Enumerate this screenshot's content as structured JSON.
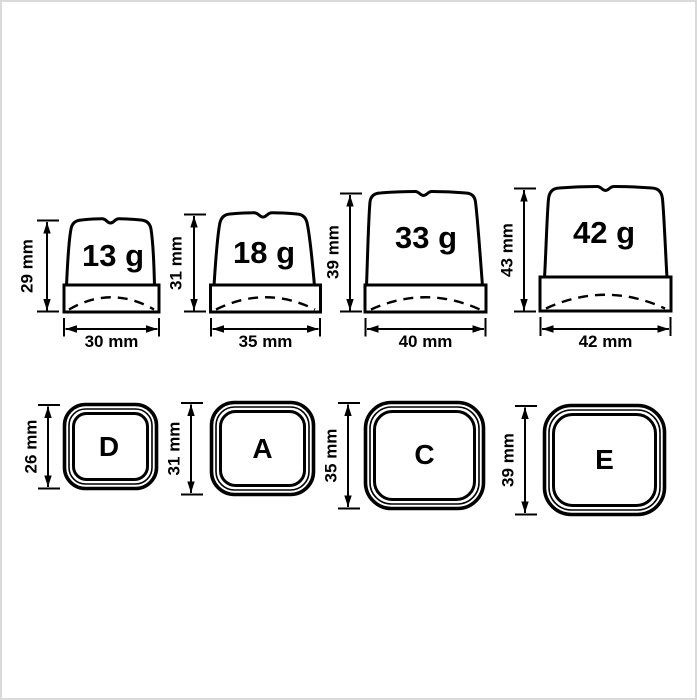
{
  "colors": {
    "line": "#000000",
    "background": "#ffffff",
    "frame_border": "#dadada"
  },
  "side_views": [
    {
      "weight": "13 g",
      "height": "29 mm",
      "width": "30 mm"
    },
    {
      "weight": "18 g",
      "height": "31 mm",
      "width": "35 mm"
    },
    {
      "weight": "33 g",
      "height": "39 mm",
      "width": "40 mm"
    },
    {
      "weight": "42 g",
      "height": "43 mm",
      "width": "42 mm"
    }
  ],
  "top_views": [
    {
      "letter": "D",
      "height": "26 mm"
    },
    {
      "letter": "A",
      "height": "31 mm"
    },
    {
      "letter": "C",
      "height": "35 mm"
    },
    {
      "letter": "E",
      "height": "39 mm"
    }
  ]
}
